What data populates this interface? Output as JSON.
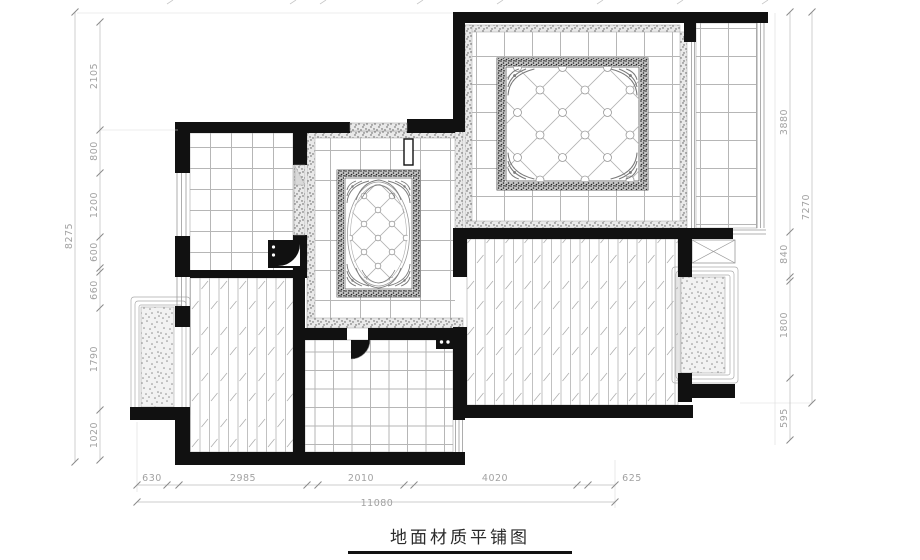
{
  "title": {
    "text": "地面材质平铺图"
  },
  "dimensions": {
    "left_outer": "8275",
    "left_chain": [
      "2105",
      "800",
      "1200",
      "600",
      "660",
      "1790",
      "1020"
    ],
    "right_chain": [
      "3880",
      "840",
      "1800",
      "595"
    ],
    "right_outer": "7270",
    "bottom_chain": [
      "630",
      "2985",
      "2010",
      "4020",
      "625"
    ],
    "bottom_outer": "11080"
  },
  "colors": {
    "wall": "#111111",
    "tile_line": "#b6b6b6",
    "dim_line": "#bbbbbb",
    "dim_text": "#a2a2a2",
    "stipple_dot": "#8c8c8c"
  }
}
